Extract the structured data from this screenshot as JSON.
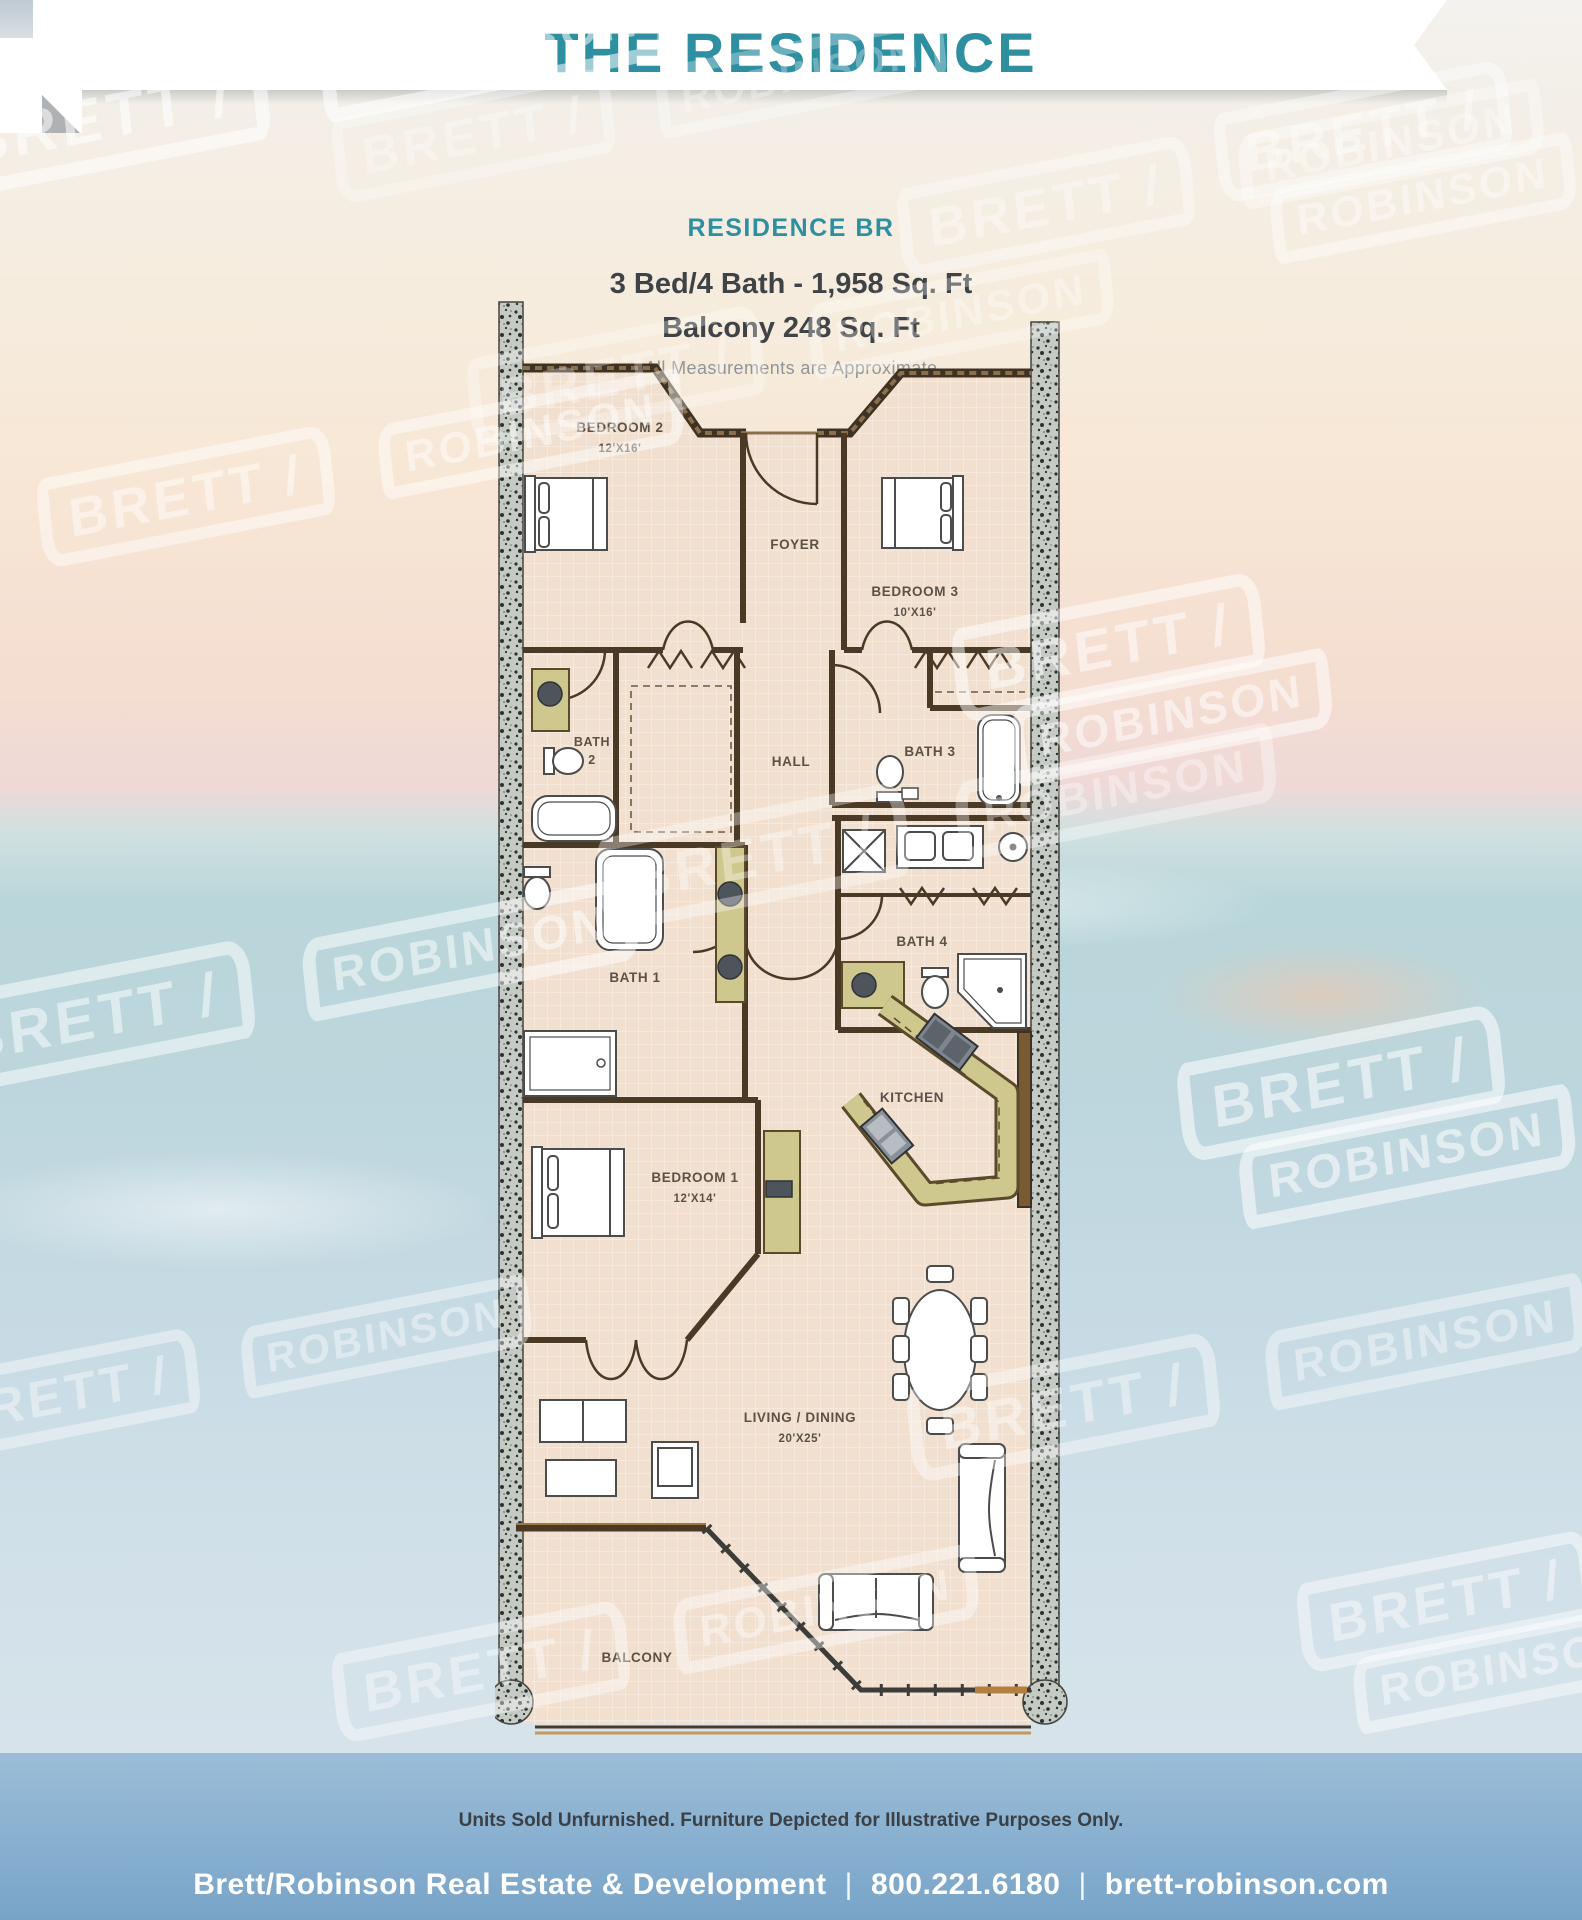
{
  "header": {
    "title": "THE RESIDENCE"
  },
  "plan_summary": {
    "name": "RESIDENCE BR",
    "specs": "3 Bed/4 Bath - 1,958 Sq. Ft",
    "balcony": "Balcony 248 Sq. Ft",
    "note": "All Measurements are Approximate"
  },
  "floor_plan": {
    "rooms": {
      "bedroom2": {
        "name": "BEDROOM 2",
        "dims": "12'X16'"
      },
      "foyer": {
        "name": "FOYER"
      },
      "bedroom3": {
        "name": "BEDROOM 3",
        "dims": "10'X16'"
      },
      "bath2": {
        "line1": "BATH",
        "line2": "2"
      },
      "hall": {
        "name": "HALL"
      },
      "bath3": {
        "name": "BATH 3"
      },
      "bath1": {
        "name": "BATH 1"
      },
      "bath4": {
        "name": "BATH 4"
      },
      "kitchen": {
        "name": "KITCHEN"
      },
      "bedroom1": {
        "name": "BEDROOM 1",
        "dims": "12'X14'"
      },
      "living_dining": {
        "name": "LIVING / DINING",
        "dims": "20'X25'"
      },
      "balcony": {
        "name": "BALCONY"
      }
    }
  },
  "watermark": {
    "line1": "BRETT /",
    "line2": "ROBINSON"
  },
  "disclaimer": "Units Sold Unfurnished. Furniture Depicted for Illustrative Purposes Only.",
  "footer": {
    "company": "Brett/Robinson Real Estate & Development",
    "phone": "800.221.6180",
    "website": "brett-robinson.com",
    "separator": "|"
  },
  "colors": {
    "teal": "#2e8fa1",
    "text_dark": "#3e4347",
    "note_gray": "#8f9498",
    "footer_band_top": "#9bbdd8",
    "footer_band_bottom": "#78a4c8",
    "footer_text": "#ffffff",
    "floor": "#f1e0d0",
    "wall_dark": "#4a3a25",
    "wall_brown": "#7a5a33",
    "cabinet_olive": "#cfc88e",
    "column_gray": "#c5cac4"
  }
}
